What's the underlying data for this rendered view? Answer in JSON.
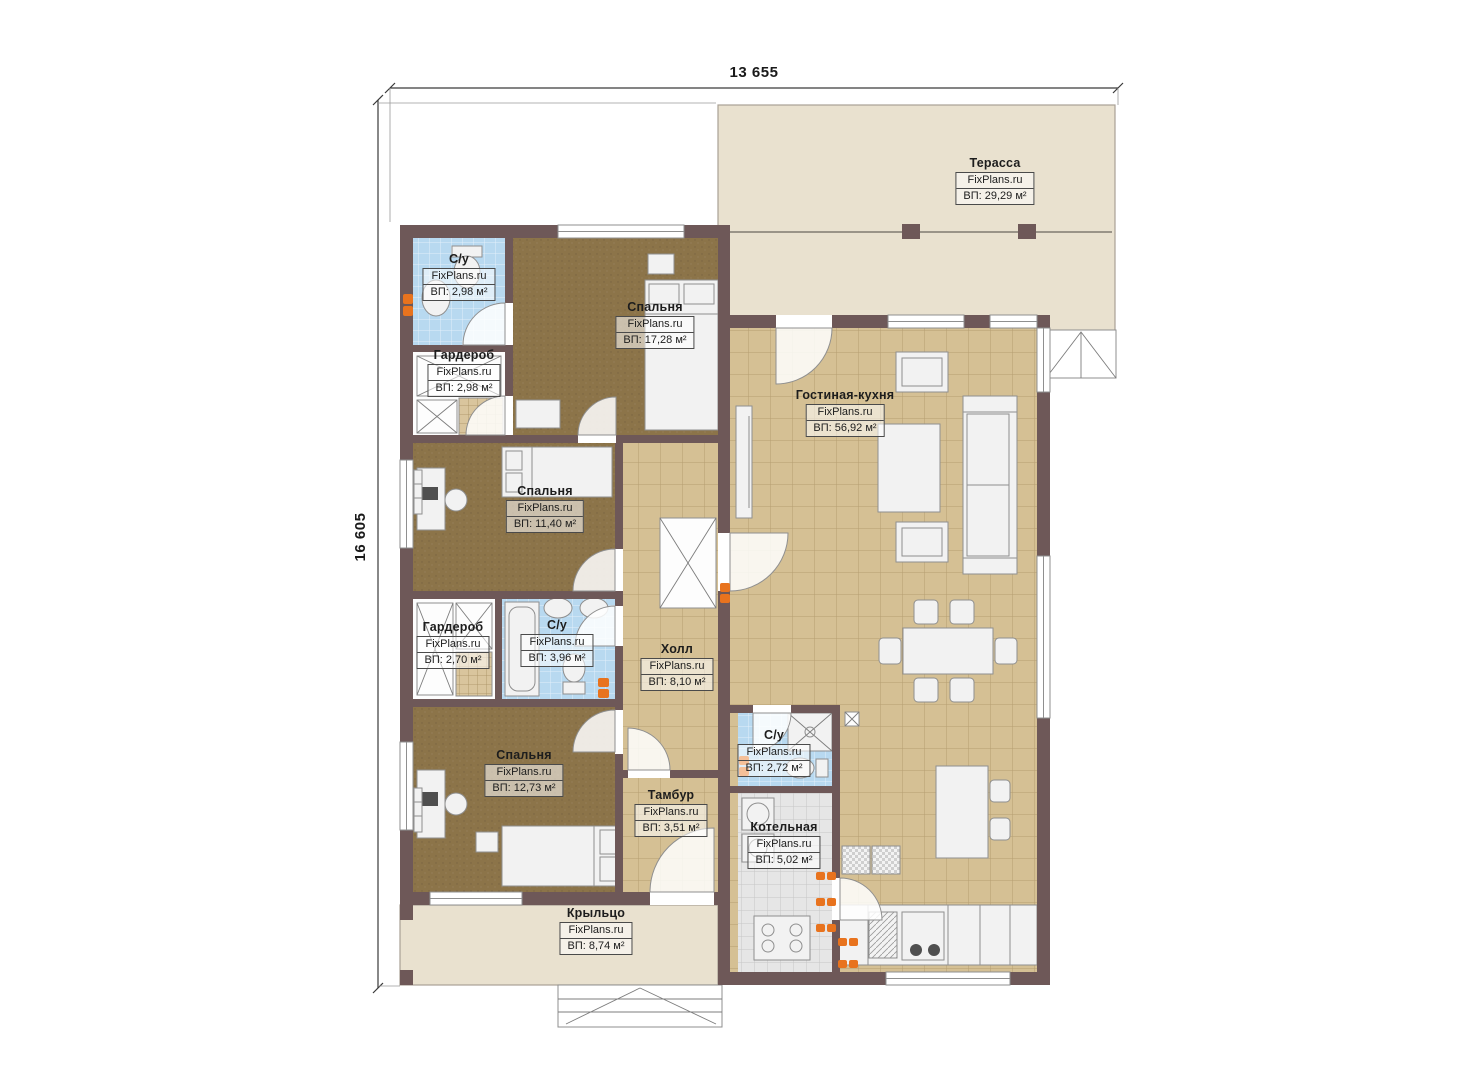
{
  "dimensions": {
    "width_mm": "13 655",
    "height_mm": "16 605"
  },
  "watermark": "FixPlans.ru",
  "rooms": [
    {
      "key": "terrace",
      "name": "Терасса",
      "brand": "FixPlans.ru",
      "area": "ВП: 29,29 м²"
    },
    {
      "key": "bedroom-1",
      "name": "Спальня",
      "brand": "FixPlans.ru",
      "area": "ВП: 17,28 м²"
    },
    {
      "key": "living-kitchen",
      "name": "Гостиная-кухня",
      "brand": "FixPlans.ru",
      "area": "ВП: 56,92 м²"
    },
    {
      "key": "bathroom-1",
      "name": "С/у",
      "brand": "FixPlans.ru",
      "area": "ВП: 2,98 м²"
    },
    {
      "key": "wardrobe-1",
      "name": "Гардероб",
      "brand": "FixPlans.ru",
      "area": "ВП: 2,98 м²"
    },
    {
      "key": "bedroom-2",
      "name": "Спальня",
      "brand": "FixPlans.ru",
      "area": "ВП: 11,40 м²"
    },
    {
      "key": "wardrobe-2",
      "name": "Гардероб",
      "brand": "FixPlans.ru",
      "area": "ВП: 2,70 м²"
    },
    {
      "key": "bathroom-2",
      "name": "С/у",
      "brand": "FixPlans.ru",
      "area": "ВП: 3,96 м²"
    },
    {
      "key": "hall",
      "name": "Холл",
      "brand": "FixPlans.ru",
      "area": "ВП: 8,10 м²"
    },
    {
      "key": "bedroom-3",
      "name": "Спальня",
      "brand": "FixPlans.ru",
      "area": "ВП: 12,73 м²"
    },
    {
      "key": "bathroom-3",
      "name": "С/у",
      "brand": "FixPlans.ru",
      "area": "ВП: 2,72 м²"
    },
    {
      "key": "vestibule",
      "name": "Тамбур",
      "brand": "FixPlans.ru",
      "area": "ВП: 3,51 м²"
    },
    {
      "key": "boiler-room",
      "name": "Котельная",
      "brand": "FixPlans.ru",
      "area": "ВП: 5,02 м²"
    },
    {
      "key": "porch",
      "name": "Крыльцо",
      "brand": "FixPlans.ru",
      "area": "ВП: 8,74 м²"
    }
  ],
  "colors": {
    "wall": "#6e5858",
    "tile_tan": "#d5c094",
    "tile_blue": "#b8d9f0",
    "tile_gray": "#e6e6e6",
    "carpet": "#8c7449",
    "terrace": "#e9e1cf",
    "furniture": "#f2f2f2",
    "accent_orange": "#e8731e"
  }
}
